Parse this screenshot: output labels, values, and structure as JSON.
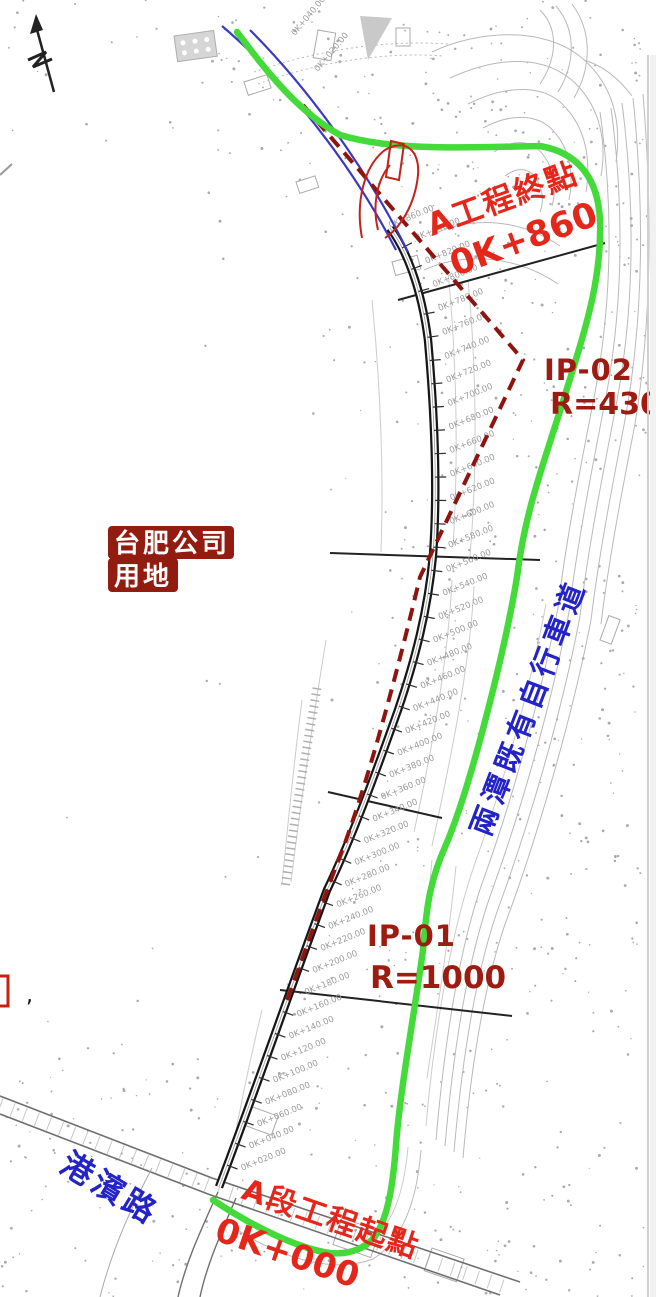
{
  "colors": {
    "bright_red": "#e5261a",
    "dark_red": "#9d1b10",
    "label_bg_red": "#931c10",
    "blue_text": "#2323c8",
    "blue_line": "#3a3ac0",
    "green_route": "#44da39",
    "red_dashed": "#8e1410",
    "road_black": "#161616",
    "contour_gray": "#b9b9b9",
    "chainage_gray": "#9b9b9b"
  },
  "annotations": {
    "project_end": {
      "line1": "A工程終點",
      "line2": "0K+860"
    },
    "ip02": {
      "name": "IP-02",
      "radius": "R=430"
    },
    "landowner": {
      "line1": "台肥公司",
      "line2": "用地"
    },
    "bike_path": {
      "text": "兩潭既有自行車道"
    },
    "ip01": {
      "name": "IP-01",
      "radius": "R=1000"
    },
    "road_name": {
      "text": "港濱路"
    },
    "project_start": {
      "line1": "A段工程起點",
      "line2": "0K+000"
    },
    "stray_mark": ","
  },
  "chainage_labels": [
    "0K+020.00",
    "0K+040.00",
    "0K+060.00",
    "0K+080.00",
    "0K+100.00",
    "0K+120.00",
    "0K+140.00",
    "0K+160.00",
    "0K+180.00",
    "0K+200.00",
    "0K+220.00",
    "0K+240.00",
    "0K+260.00",
    "0K+280.00",
    "0K+300.00",
    "0K+320.00",
    "0K+340.00",
    "0K+360.00",
    "0K+380.00",
    "0K+400.00",
    "0K+420.00",
    "0K+440.00",
    "0K+460.00",
    "0K+480.00",
    "0K+500.00",
    "0K+520.00",
    "0K+540.00",
    "0K+560.00",
    "0K+580.00",
    "0K+600.00",
    "0K+620.00",
    "0K+640.00",
    "0K+660.00",
    "0K+680.00",
    "0K+700.00",
    "0K+720.00",
    "0K+740.00",
    "0K+760.00",
    "0K+780.00",
    "0K+800.00",
    "0K+820.00",
    "0K+840.00",
    "0K+860.00"
  ],
  "upper_chainage_labels": [
    "0K+020.00",
    "0K+040.00"
  ]
}
